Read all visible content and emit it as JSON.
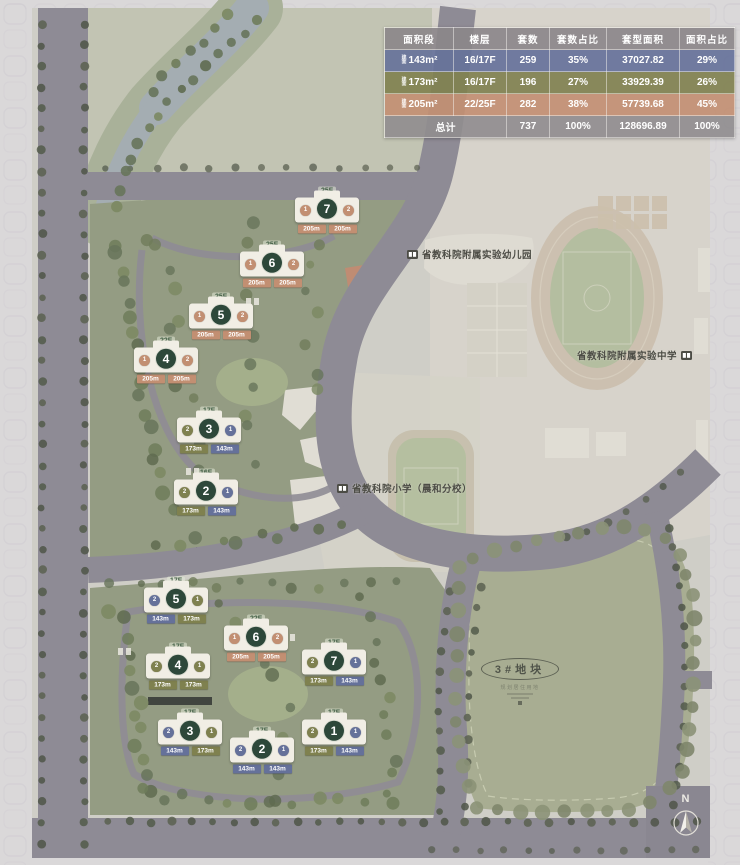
{
  "table": {
    "headers": [
      "面积段",
      "楼层",
      "套数",
      "套数占比",
      "套型面积",
      "面积占比"
    ],
    "rows": [
      {
        "prefix": "建面",
        "area": "143m²",
        "floor": "16/17F",
        "units": "259",
        "units_pct": "35%",
        "gfa": "37027.82",
        "gfa_pct": "29%",
        "type": "143"
      },
      {
        "prefix": "建面",
        "area": "173m²",
        "floor": "16/17F",
        "units": "196",
        "units_pct": "27%",
        "gfa": "33929.39",
        "gfa_pct": "26%",
        "type": "173"
      },
      {
        "prefix": "建面",
        "area": "205m²",
        "floor": "22/25F",
        "units": "282",
        "units_pct": "38%",
        "gfa": "57739.68",
        "gfa_pct": "45%",
        "type": "205"
      }
    ],
    "total": {
      "label": "总计",
      "units": "737",
      "units_pct": "100%",
      "gfa": "128696.89",
      "gfa_pct": "100%"
    }
  },
  "colors": {
    "143": "#65719a",
    "173": "#7f814f",
    "205": "#c28f72",
    "header": "#8b8689",
    "total": "#908d8f",
    "building_circle": "#2d483a"
  },
  "labels": {
    "kindergarten": "省教科院附属实验幼儿园",
    "middle_school": "省教科院附属实验中学",
    "primary_school": "省教科院小学（晨和分校）",
    "parcel": "3#地块",
    "parcel_sub": "规划居住用地",
    "north": "N"
  },
  "clusters": [
    {
      "name": "north-cluster",
      "buildings": [
        {
          "num": "7",
          "x": 327,
          "y": 211,
          "floor": "25F",
          "units": [
            {
              "n": "1",
              "t": "205"
            },
            {
              "n": "2",
              "t": "205"
            }
          ],
          "tags": [
            {
              "label": "205m",
              "t": "205"
            },
            {
              "label": "205m",
              "t": "205"
            }
          ]
        },
        {
          "num": "6",
          "x": 272,
          "y": 265,
          "floor": "25F",
          "units": [
            {
              "n": "1",
              "t": "205"
            },
            {
              "n": "2",
              "t": "205"
            }
          ],
          "tags": [
            {
              "label": "205m",
              "t": "205"
            },
            {
              "label": "205m",
              "t": "205"
            }
          ]
        },
        {
          "num": "5",
          "x": 221,
          "y": 317,
          "floor": "25F",
          "units": [
            {
              "n": "1",
              "t": "205"
            },
            {
              "n": "2",
              "t": "205"
            }
          ],
          "tags": [
            {
              "label": "205m",
              "t": "205"
            },
            {
              "label": "205m",
              "t": "205"
            }
          ]
        },
        {
          "num": "4",
          "x": 166,
          "y": 361,
          "floor": "22F",
          "units": [
            {
              "n": "1",
              "t": "205"
            },
            {
              "n": "2",
              "t": "205"
            }
          ],
          "tags": [
            {
              "label": "205m",
              "t": "205"
            },
            {
              "label": "205m",
              "t": "205"
            }
          ]
        },
        {
          "num": "3",
          "x": 209,
          "y": 431,
          "floor": "17F",
          "units": [
            {
              "n": "2",
              "t": "173"
            },
            {
              "n": "1",
              "t": "143"
            }
          ],
          "tags": [
            {
              "label": "173m",
              "t": "173"
            },
            {
              "label": "143m",
              "t": "143"
            }
          ]
        },
        {
          "num": "2",
          "x": 206,
          "y": 493,
          "floor": "16F",
          "units": [
            {
              "n": "2",
              "t": "173"
            },
            {
              "n": "1",
              "t": "143"
            }
          ],
          "tags": [
            {
              "label": "173m",
              "t": "173"
            },
            {
              "label": "143m",
              "t": "143"
            }
          ]
        }
      ]
    },
    {
      "name": "south-cluster",
      "buildings": [
        {
          "num": "5",
          "x": 176,
          "y": 601,
          "floor": "17F",
          "units": [
            {
              "n": "2",
              "t": "143"
            },
            {
              "n": "1",
              "t": "173"
            }
          ],
          "tags": [
            {
              "label": "143m",
              "t": "143"
            },
            {
              "label": "173m",
              "t": "173"
            }
          ]
        },
        {
          "num": "6",
          "x": 256,
          "y": 639,
          "floor": "22F",
          "units": [
            {
              "n": "1",
              "t": "205"
            },
            {
              "n": "2",
              "t": "205"
            }
          ],
          "tags": [
            {
              "label": "205m",
              "t": "205"
            },
            {
              "label": "205m",
              "t": "205"
            }
          ]
        },
        {
          "num": "4",
          "x": 178,
          "y": 667,
          "floor": "17F",
          "units": [
            {
              "n": "2",
              "t": "173"
            },
            {
              "n": "1",
              "t": "173"
            }
          ],
          "tags": [
            {
              "label": "173m",
              "t": "173"
            },
            {
              "label": "173m",
              "t": "173"
            }
          ]
        },
        {
          "num": "7",
          "x": 334,
          "y": 663,
          "floor": "17F",
          "units": [
            {
              "n": "2",
              "t": "173"
            },
            {
              "n": "1",
              "t": "143"
            }
          ],
          "tags": [
            {
              "label": "173m",
              "t": "173"
            },
            {
              "label": "143m",
              "t": "143"
            }
          ]
        },
        {
          "num": "3",
          "x": 190,
          "y": 733,
          "floor": "17F",
          "units": [
            {
              "n": "2",
              "t": "143"
            },
            {
              "n": "1",
              "t": "173"
            }
          ],
          "tags": [
            {
              "label": "143m",
              "t": "143"
            },
            {
              "label": "173m",
              "t": "173"
            }
          ]
        },
        {
          "num": "2",
          "x": 262,
          "y": 751,
          "floor": "17F",
          "units": [
            {
              "n": "2",
              "t": "143"
            },
            {
              "n": "1",
              "t": "143"
            }
          ],
          "tags": [
            {
              "label": "143m",
              "t": "143"
            },
            {
              "label": "143m",
              "t": "143"
            }
          ]
        },
        {
          "num": "1",
          "x": 334,
          "y": 733,
          "floor": "17F",
          "units": [
            {
              "n": "2",
              "t": "173"
            },
            {
              "n": "1",
              "t": "143"
            }
          ],
          "tags": [
            {
              "label": "173m",
              "t": "173"
            },
            {
              "label": "143m",
              "t": "143"
            }
          ]
        }
      ]
    }
  ]
}
